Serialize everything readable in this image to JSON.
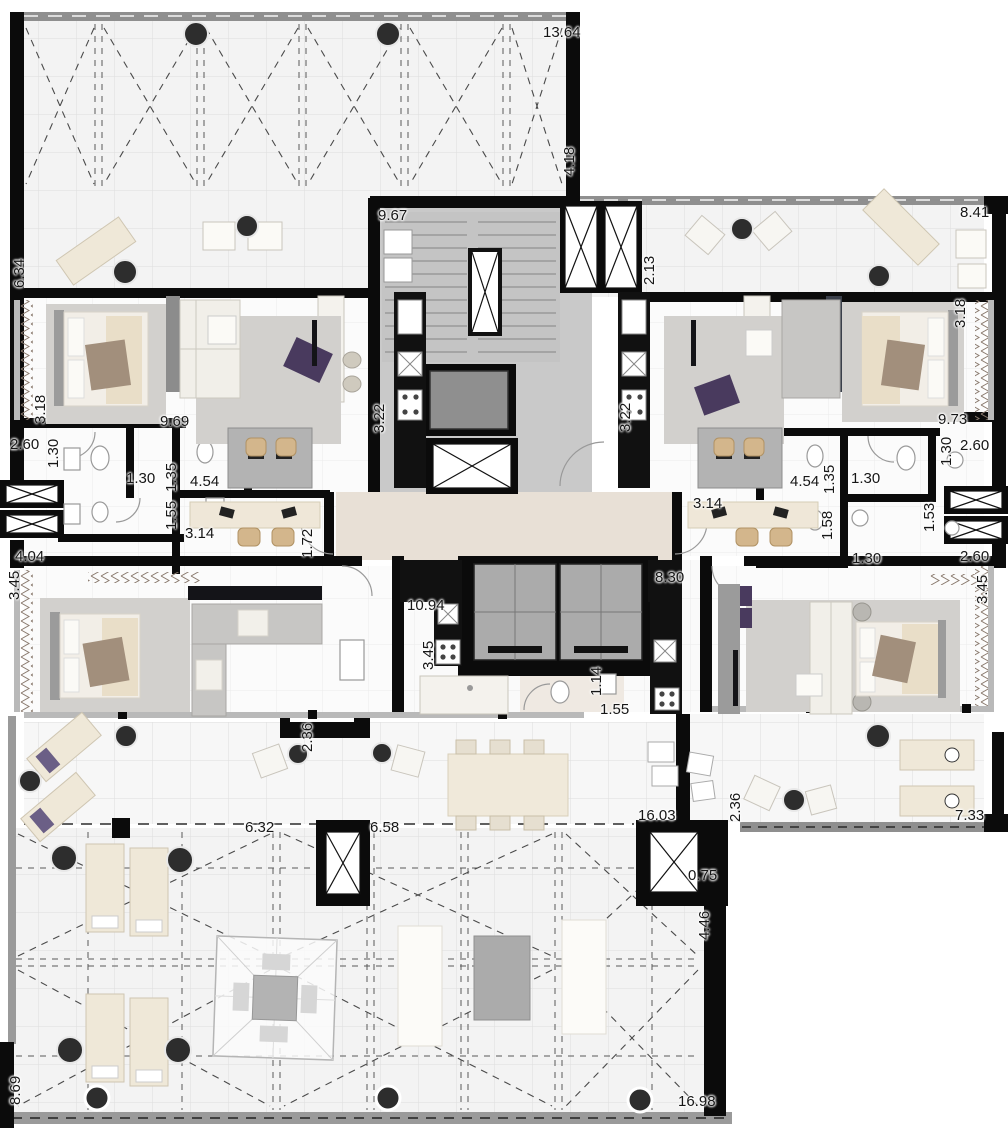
{
  "document": {
    "kind": "architectural-floor-plan",
    "content": "residential tower floor with two upper units, central elevator-stair core, two master suites and wrap-around terraces"
  },
  "palette": {
    "wall": "#0b0b0b",
    "railing": "#8f8f8f",
    "terrace_floor": "#f3f3f3",
    "apartment_floor": "#fbfbfb",
    "core_floor": "#c9c9c9",
    "foyer_floor": "#e8e0d6",
    "rug": "#d2d0cd",
    "accent_purple": "#493a5e",
    "lounger": "#efe8d8",
    "chair_wood": "#d3b68c",
    "elevator_car": "#ababab"
  },
  "features": [
    "staircase-icon",
    "stair-void-icon",
    "elevator-icon",
    "service-elevator-icon",
    "ventilation-shaft-icon",
    "kitchen-counter-icon",
    "cooktop-icon",
    "sink-icon",
    "bed-icon",
    "sofa-icon",
    "lounger-icon",
    "dining-table-icon",
    "desk-icon",
    "toilet-icon",
    "gazebo-icon",
    "column-icon",
    "curtain-window-icon",
    "washer-dryer-icon"
  ],
  "dimensions": [
    {
      "text": "13.64",
      "x": 543,
      "y": 25,
      "rot": 0
    },
    {
      "text": "4.18",
      "x": 562,
      "y": 176,
      "rot": -90
    },
    {
      "text": "9.67",
      "x": 378,
      "y": 208,
      "rot": 0
    },
    {
      "text": "8.41",
      "x": 960,
      "y": 205,
      "rot": 0
    },
    {
      "text": "6.34",
      "x": 12,
      "y": 288,
      "rot": -90
    },
    {
      "text": "2.13",
      "x": 642,
      "y": 285,
      "rot": -90
    },
    {
      "text": "3.18",
      "x": 33,
      "y": 424,
      "rot": -90
    },
    {
      "text": "9.69",
      "x": 160,
      "y": 414,
      "rot": 0
    },
    {
      "text": "3.22",
      "x": 372,
      "y": 433,
      "rot": -90
    },
    {
      "text": "3.22",
      "x": 618,
      "y": 432,
      "rot": -90
    },
    {
      "text": "3.18",
      "x": 953,
      "y": 328,
      "rot": -90
    },
    {
      "text": "9.73",
      "x": 938,
      "y": 412,
      "rot": 0
    },
    {
      "text": "2.60",
      "x": 10,
      "y": 437,
      "rot": 0
    },
    {
      "text": "1.30",
      "x": 46,
      "y": 468,
      "rot": -90
    },
    {
      "text": "1.30",
      "x": 126,
      "y": 471,
      "rot": 0
    },
    {
      "text": "1.35",
      "x": 164,
      "y": 492,
      "rot": -90
    },
    {
      "text": "4.54",
      "x": 190,
      "y": 474,
      "rot": 0
    },
    {
      "text": "1.55",
      "x": 164,
      "y": 530,
      "rot": -90
    },
    {
      "text": "3.14",
      "x": 185,
      "y": 526,
      "rot": 0
    },
    {
      "text": "1.72",
      "x": 300,
      "y": 558,
      "rot": -90
    },
    {
      "text": "4.04",
      "x": 15,
      "y": 549,
      "rot": 0
    },
    {
      "text": "3.45",
      "x": 7,
      "y": 600,
      "rot": -90
    },
    {
      "text": "1.30",
      "x": 939,
      "y": 466,
      "rot": -90
    },
    {
      "text": "2.60",
      "x": 960,
      "y": 438,
      "rot": 0
    },
    {
      "text": "4.54",
      "x": 790,
      "y": 474,
      "rot": 0
    },
    {
      "text": "1.35",
      "x": 822,
      "y": 494,
      "rot": -90
    },
    {
      "text": "1.30",
      "x": 851,
      "y": 471,
      "rot": 0
    },
    {
      "text": "3.14",
      "x": 693,
      "y": 496,
      "rot": 0
    },
    {
      "text": "1.58",
      "x": 820,
      "y": 540,
      "rot": -90
    },
    {
      "text": "1.53",
      "x": 922,
      "y": 532,
      "rot": -90
    },
    {
      "text": "1.30",
      "x": 852,
      "y": 551,
      "rot": 0
    },
    {
      "text": "2.60",
      "x": 960,
      "y": 549,
      "rot": 0
    },
    {
      "text": "3.45",
      "x": 975,
      "y": 604,
      "rot": -90
    },
    {
      "text": "10.94",
      "x": 407,
      "y": 598,
      "rot": 0
    },
    {
      "text": "8.30",
      "x": 655,
      "y": 570,
      "rot": 0
    },
    {
      "text": "3.45",
      "x": 421,
      "y": 670,
      "rot": -90
    },
    {
      "text": "1.14",
      "x": 589,
      "y": 696,
      "rot": -90
    },
    {
      "text": "1.55",
      "x": 600,
      "y": 702,
      "rot": 0
    },
    {
      "text": "2.36",
      "x": 300,
      "y": 752,
      "rot": -90
    },
    {
      "text": "2.36",
      "x": 728,
      "y": 822,
      "rot": -90
    },
    {
      "text": "16.03",
      "x": 638,
      "y": 808,
      "rot": 0
    },
    {
      "text": "0.75",
      "x": 688,
      "y": 868,
      "rot": 0
    },
    {
      "text": "4.46",
      "x": 697,
      "y": 940,
      "rot": -90
    },
    {
      "text": "7.33",
      "x": 955,
      "y": 808,
      "rot": 0
    },
    {
      "text": "6.32",
      "x": 245,
      "y": 820,
      "rot": 0
    },
    {
      "text": "6.58",
      "x": 370,
      "y": 820,
      "rot": 0
    },
    {
      "text": "8.69",
      "x": 8,
      "y": 1105,
      "rot": -90
    },
    {
      "text": "16.98",
      "x": 678,
      "y": 1094,
      "rot": 0
    }
  ]
}
